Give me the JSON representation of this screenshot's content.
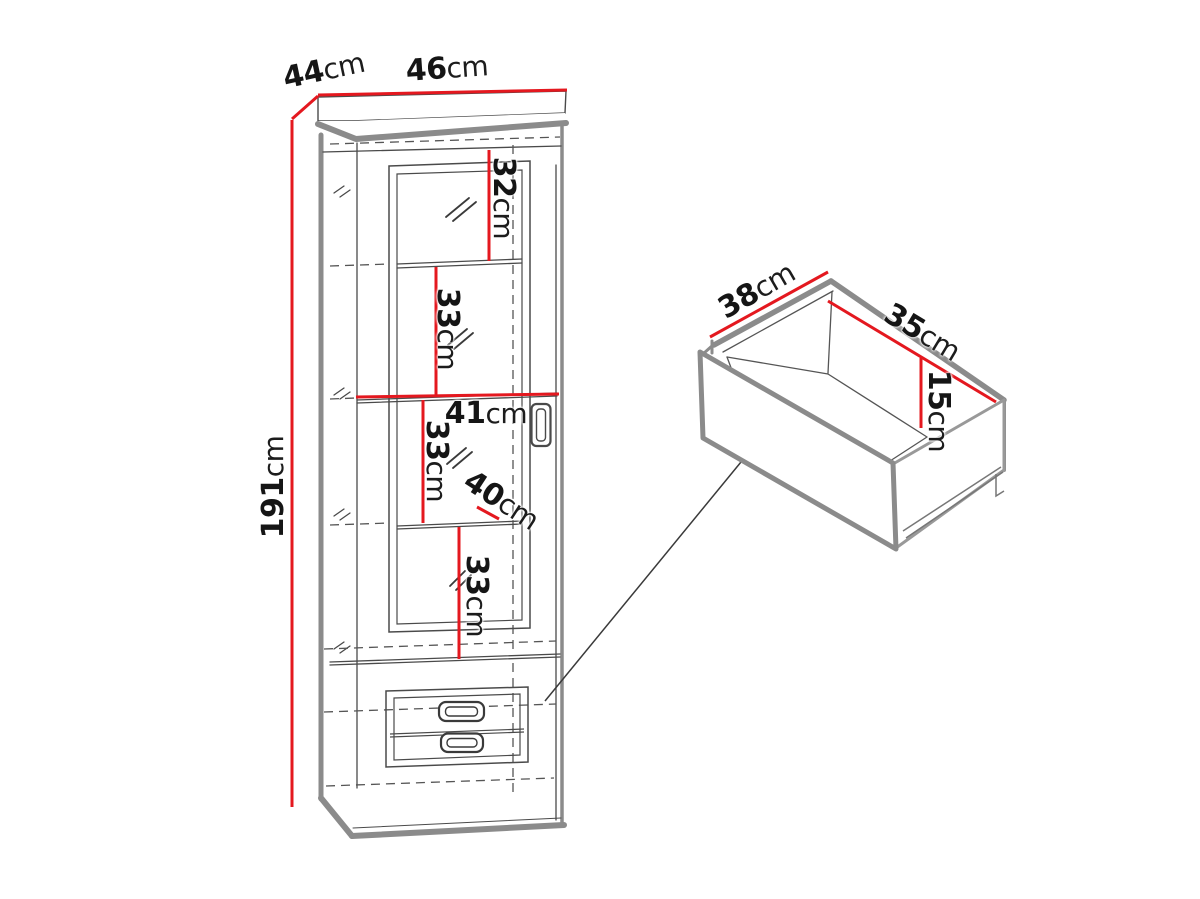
{
  "figure": {
    "title": "furniture dimension diagram",
    "background": "#ffffff",
    "colors": {
      "dimension_line": "#e4181f",
      "outline_gray": "#8b8b8b",
      "sketch_line": "#4a4a4a",
      "text": "#151515"
    },
    "cabinet": {
      "name": "tall display cabinet with glass door and two drawers",
      "dimensions": [
        {
          "id": "top-depth",
          "value": "44",
          "unit": "cm"
        },
        {
          "id": "top-width",
          "value": "46",
          "unit": "cm"
        },
        {
          "id": "height",
          "value": "191",
          "unit": "cm"
        },
        {
          "id": "compartment-1",
          "value": "32",
          "unit": "cm"
        },
        {
          "id": "compartment-2",
          "value": "33",
          "unit": "cm"
        },
        {
          "id": "inner-width",
          "value": "41",
          "unit": "cm"
        },
        {
          "id": "compartment-3",
          "value": "33",
          "unit": "cm"
        },
        {
          "id": "inner-depth",
          "value": "40",
          "unit": "cm"
        },
        {
          "id": "compartment-4",
          "value": "33",
          "unit": "cm"
        }
      ]
    },
    "drawer": {
      "name": "drawer box detail",
      "dimensions": [
        {
          "id": "drawer-width",
          "value": "38",
          "unit": "cm"
        },
        {
          "id": "drawer-depth",
          "value": "35",
          "unit": "cm"
        },
        {
          "id": "drawer-height",
          "value": "15",
          "unit": "cm"
        }
      ]
    }
  }
}
